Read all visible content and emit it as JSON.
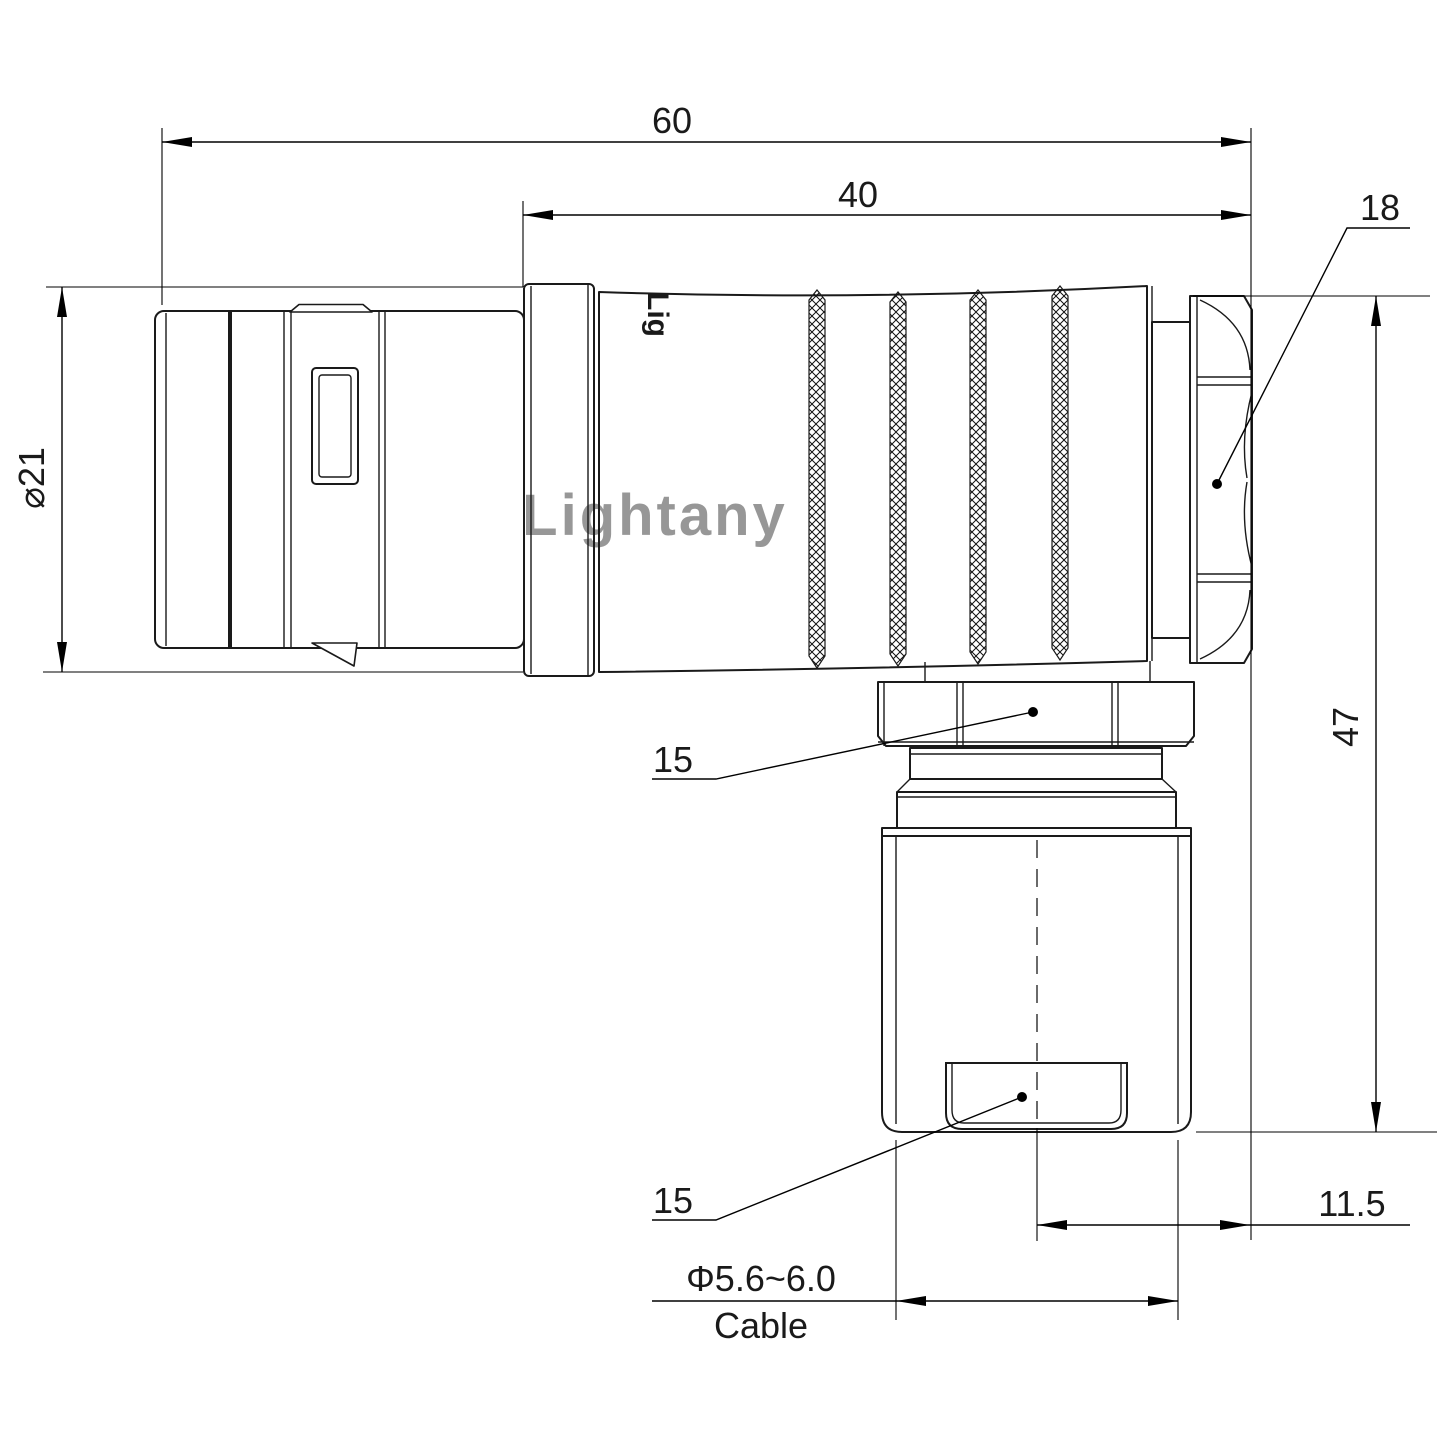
{
  "drawing": {
    "watermark": "Lightany",
    "part_logo": "Lig",
    "colors": {
      "line": "#1a1a1a",
      "watermark": "#efc6c6"
    },
    "dimensions": {
      "total_length": "60",
      "rear_length": "40",
      "back_nut_size": "18",
      "shell_diameter": "⌀21",
      "overall_height": "47",
      "coupling_nut_size": "15",
      "clamp_size": "15",
      "cable_offset": "11.5",
      "cable_diameter": "Φ5.6~6.0",
      "cable_label": "Cable"
    }
  }
}
